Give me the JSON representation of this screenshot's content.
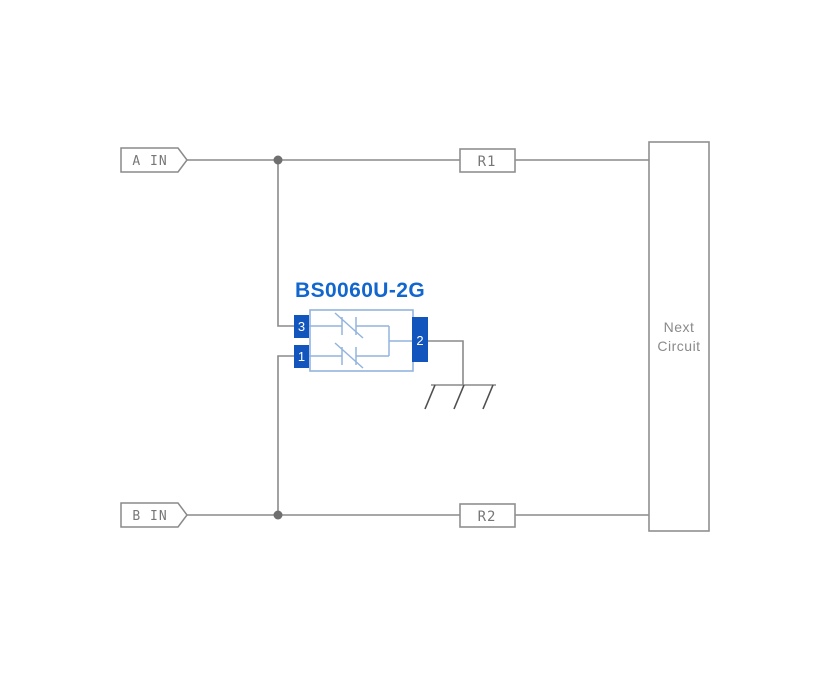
{
  "colors": {
    "background": "#ffffff",
    "wire_gray": "#8a8a8a",
    "junction_dot_gray": "#6f6f6f",
    "net_text_gray": "#777777",
    "box_border_gray": "#8f8f8f",
    "next_circuit_text_gray": "#8a8a8a",
    "component_light_blue": "#93b4de",
    "pin_blue": "#1155bd",
    "part_label_blue": "#1267cf",
    "ground_dark_gray": "#4f4f4f",
    "pin_text_white": "#ffffff"
  },
  "diagram": {
    "component_label": "BS0060U-2G",
    "inputs": [
      {
        "label": "A IN"
      },
      {
        "label": "B IN"
      }
    ],
    "resistors": [
      {
        "label": "R1"
      },
      {
        "label": "R2"
      }
    ],
    "next_circuit_label": "Next Circuit",
    "pins": {
      "top_left": "3",
      "bottom_left": "1",
      "right": "2"
    },
    "icons": {
      "junction": "junction-dot",
      "ground": "chassis-ground-icon",
      "tvs_element": "tvs-diode-symbol"
    }
  }
}
